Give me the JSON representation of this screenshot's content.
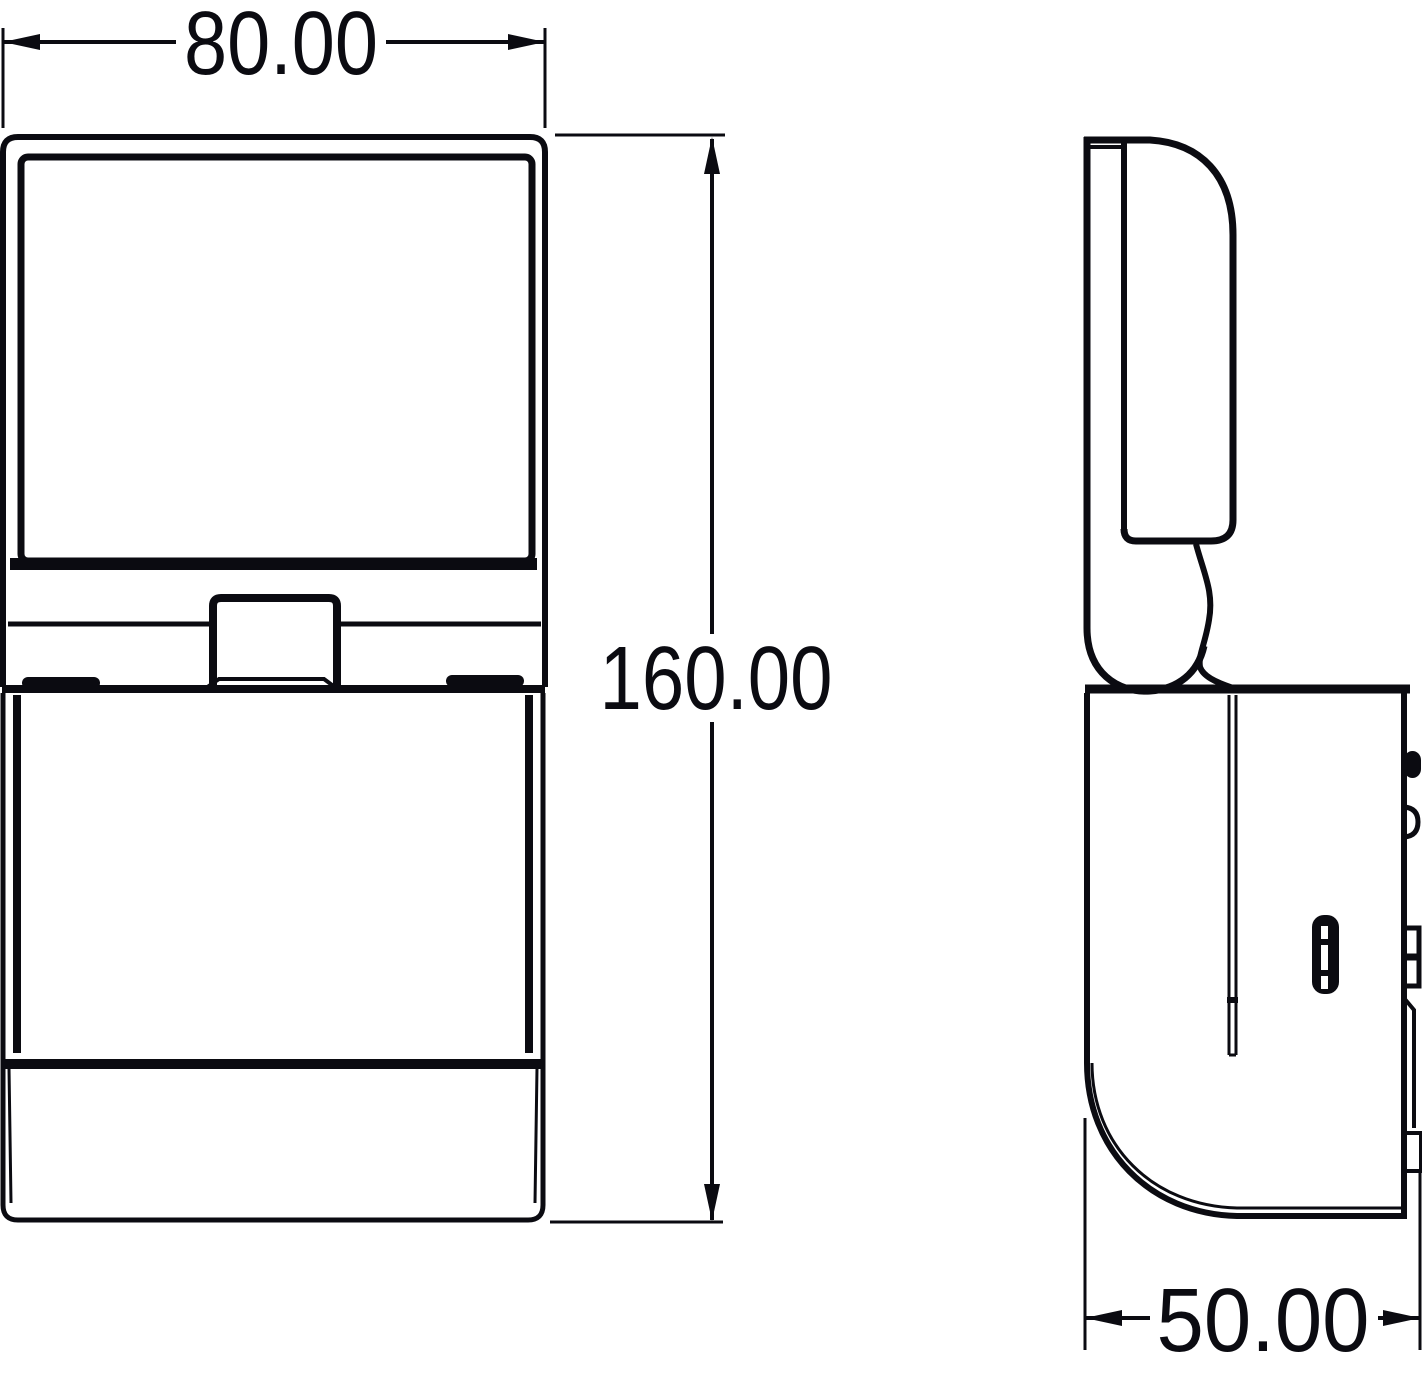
{
  "page": {
    "background_color": "#ffffff",
    "line_color": "#0b0b11"
  },
  "drawing": {
    "dimensions": {
      "width": {
        "value": "80.00"
      },
      "height": {
        "value": "160.00"
      },
      "depth": {
        "value": "50.00"
      }
    }
  }
}
